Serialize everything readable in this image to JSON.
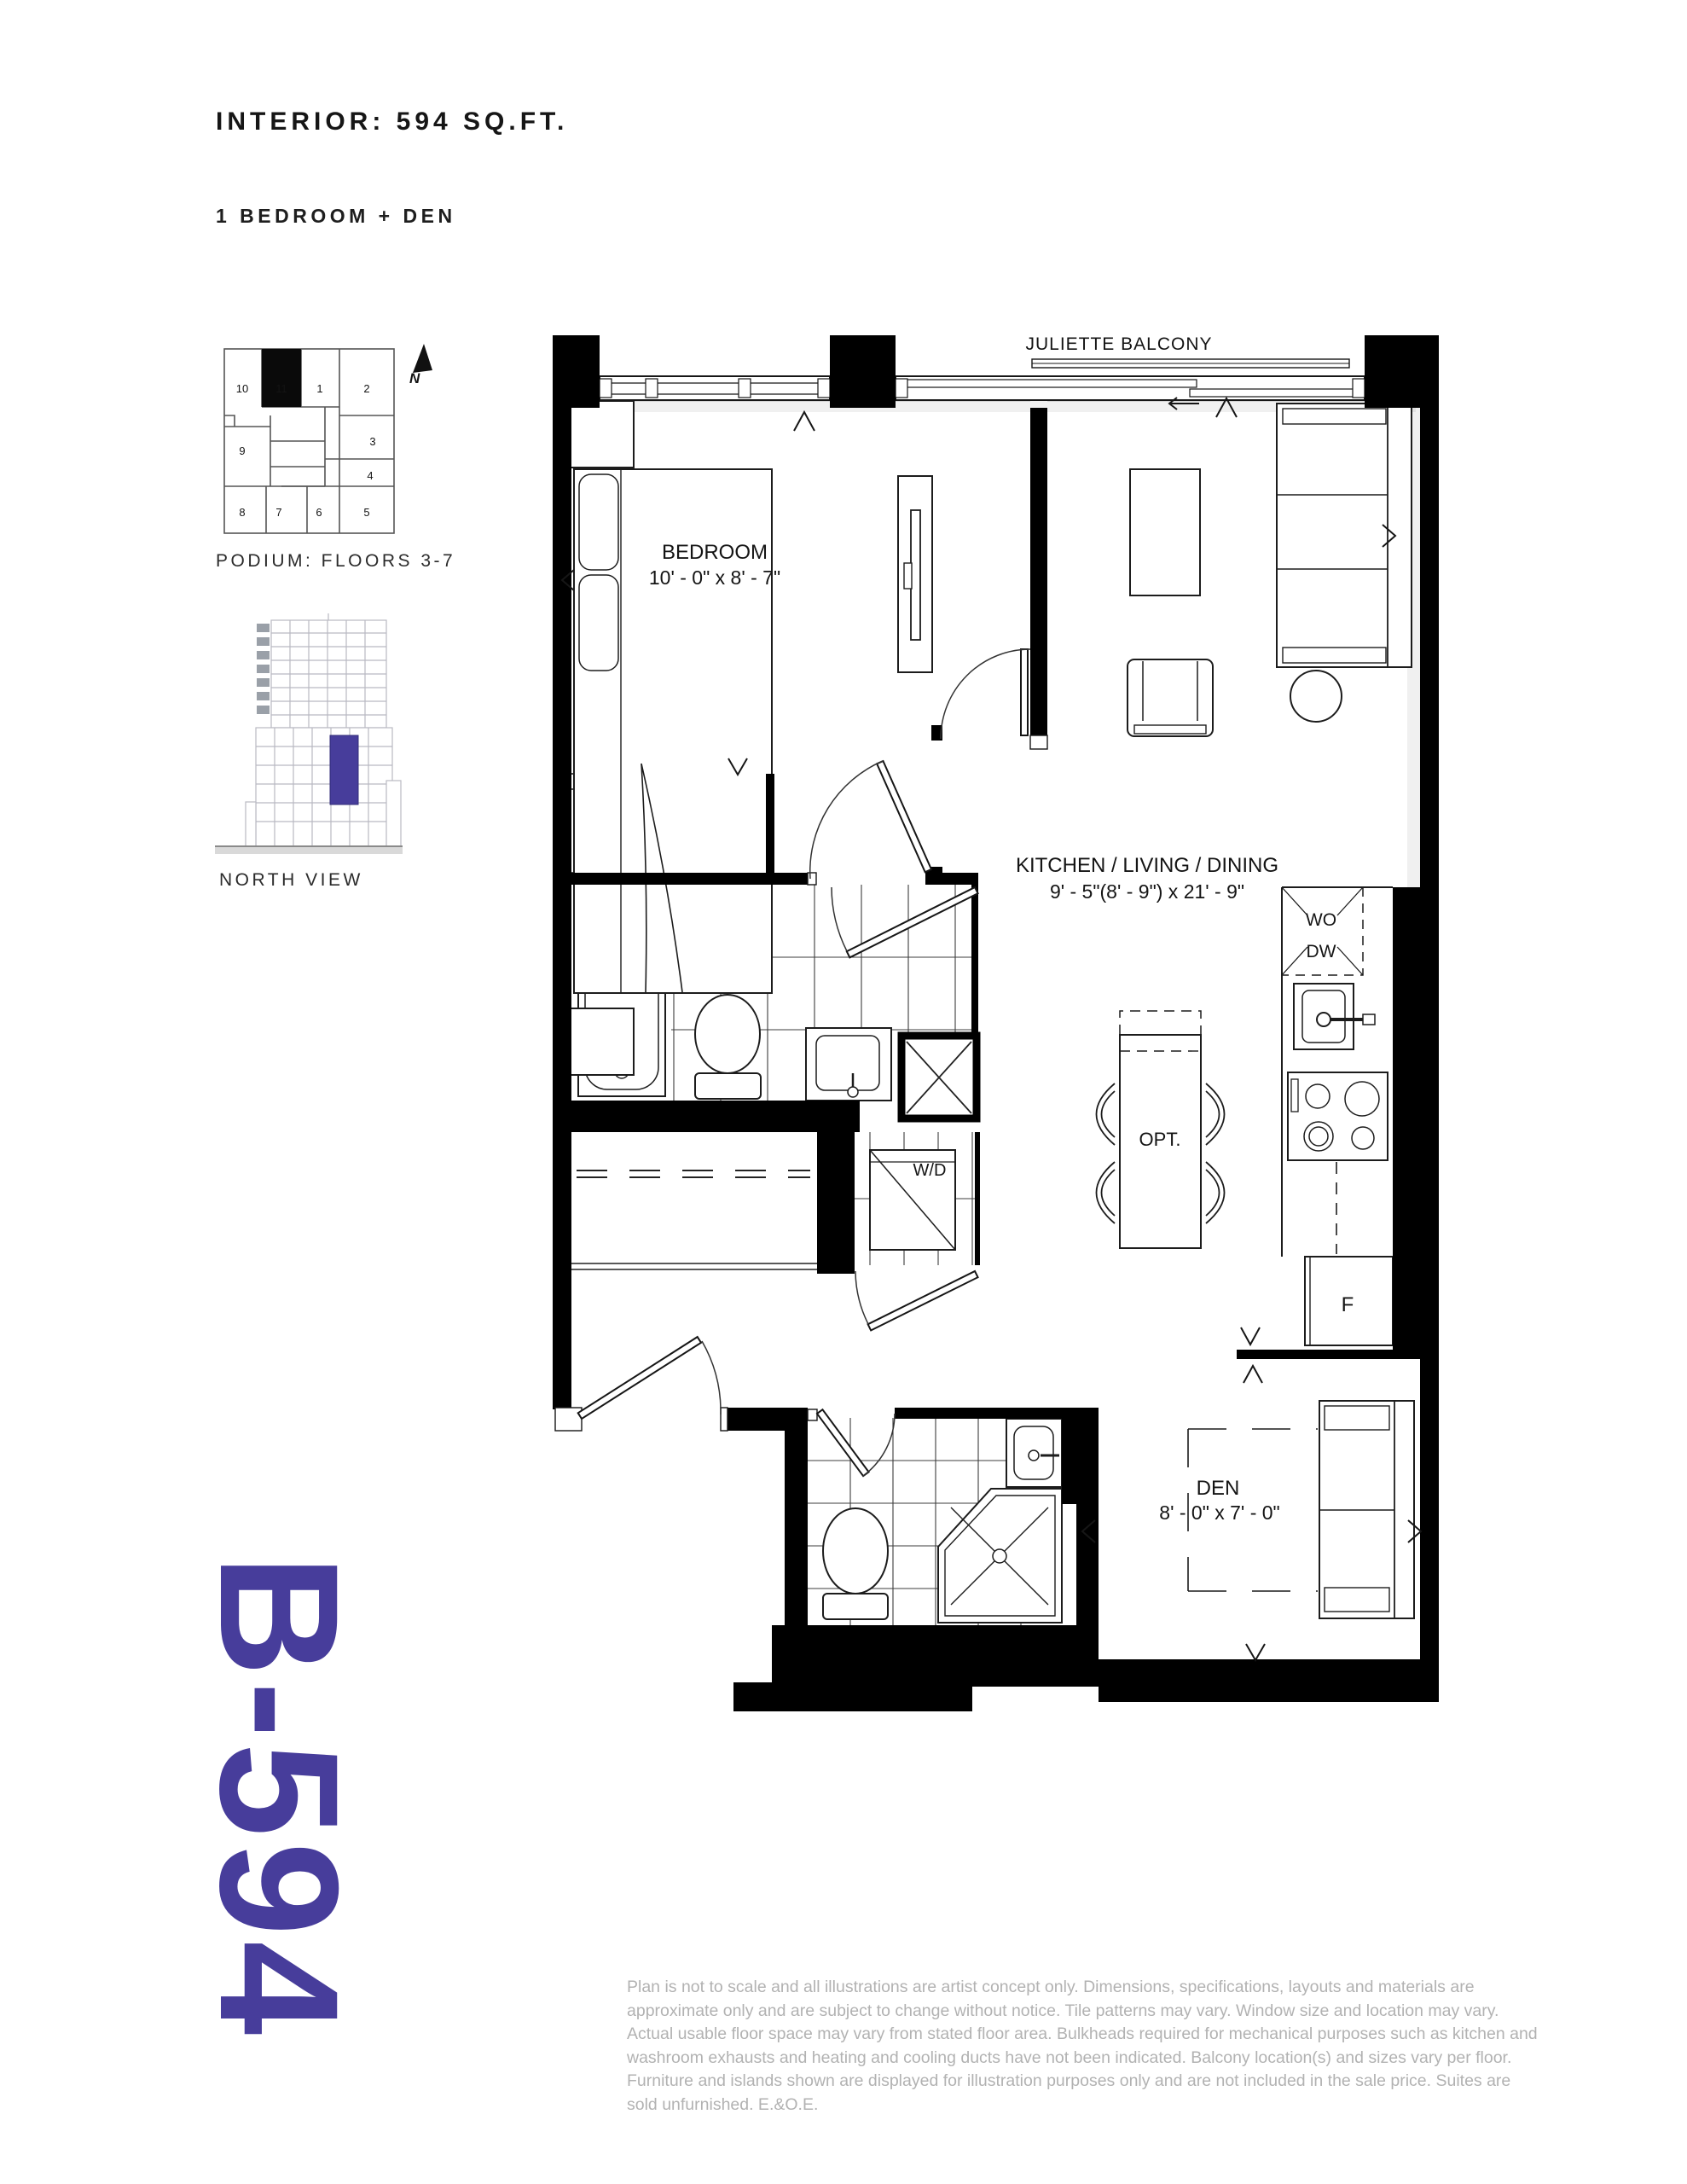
{
  "header": {
    "title": "INTERIOR: 594 SQ.FT.",
    "subtitle": "1 BEDROOM + DEN"
  },
  "keyplan": {
    "caption": "PODIUM: FLOORS 3-7",
    "north_label": "N",
    "highlighted_unit": "11",
    "units": [
      "10",
      "11",
      "1",
      "2",
      "3",
      "4",
      "5",
      "6",
      "7",
      "8",
      "9"
    ]
  },
  "elevation": {
    "caption": "NORTH VIEW"
  },
  "unit_code": "B-594",
  "plan": {
    "balcony_label": "JULIETTE BALCONY",
    "rooms": [
      {
        "name": "BEDROOM",
        "dims": "10' - 0\" x 8' - 7\""
      },
      {
        "name": "KITCHEN / LIVING / DINING",
        "dims": "9' - 5\"(8' - 9\")  x 21' - 9\""
      },
      {
        "name": "DEN",
        "dims": "8' - 0\" x 7' - 0\""
      }
    ],
    "appliances": {
      "washer_dryer": "W/D",
      "wall_oven": "WO",
      "dishwasher": "DW",
      "fridge": "F",
      "optional_island": "OPT."
    }
  },
  "disclaimer": "Plan is not to scale and all illustrations are artist concept only. Dimensions, specifications, layouts and materials are approximate only and are subject to change without notice. Tile patterns may vary. Window size and location may vary. Actual usable floor space may vary from stated floor area. Bulkheads required for mechanical purposes such as kitchen and washroom exhausts and heating and cooling ducts have not been indicated. Balcony location(s) and sizes vary per floor. Furniture and islands shown are displayed for illustration purposes only and are not included in the sale price. Suites are sold unfurnished. E.&O.E.",
  "colors": {
    "accent": "#473D9B",
    "walls": "#000000",
    "line": "#1a1a1a",
    "disclaimer": "#b2b2b2"
  }
}
